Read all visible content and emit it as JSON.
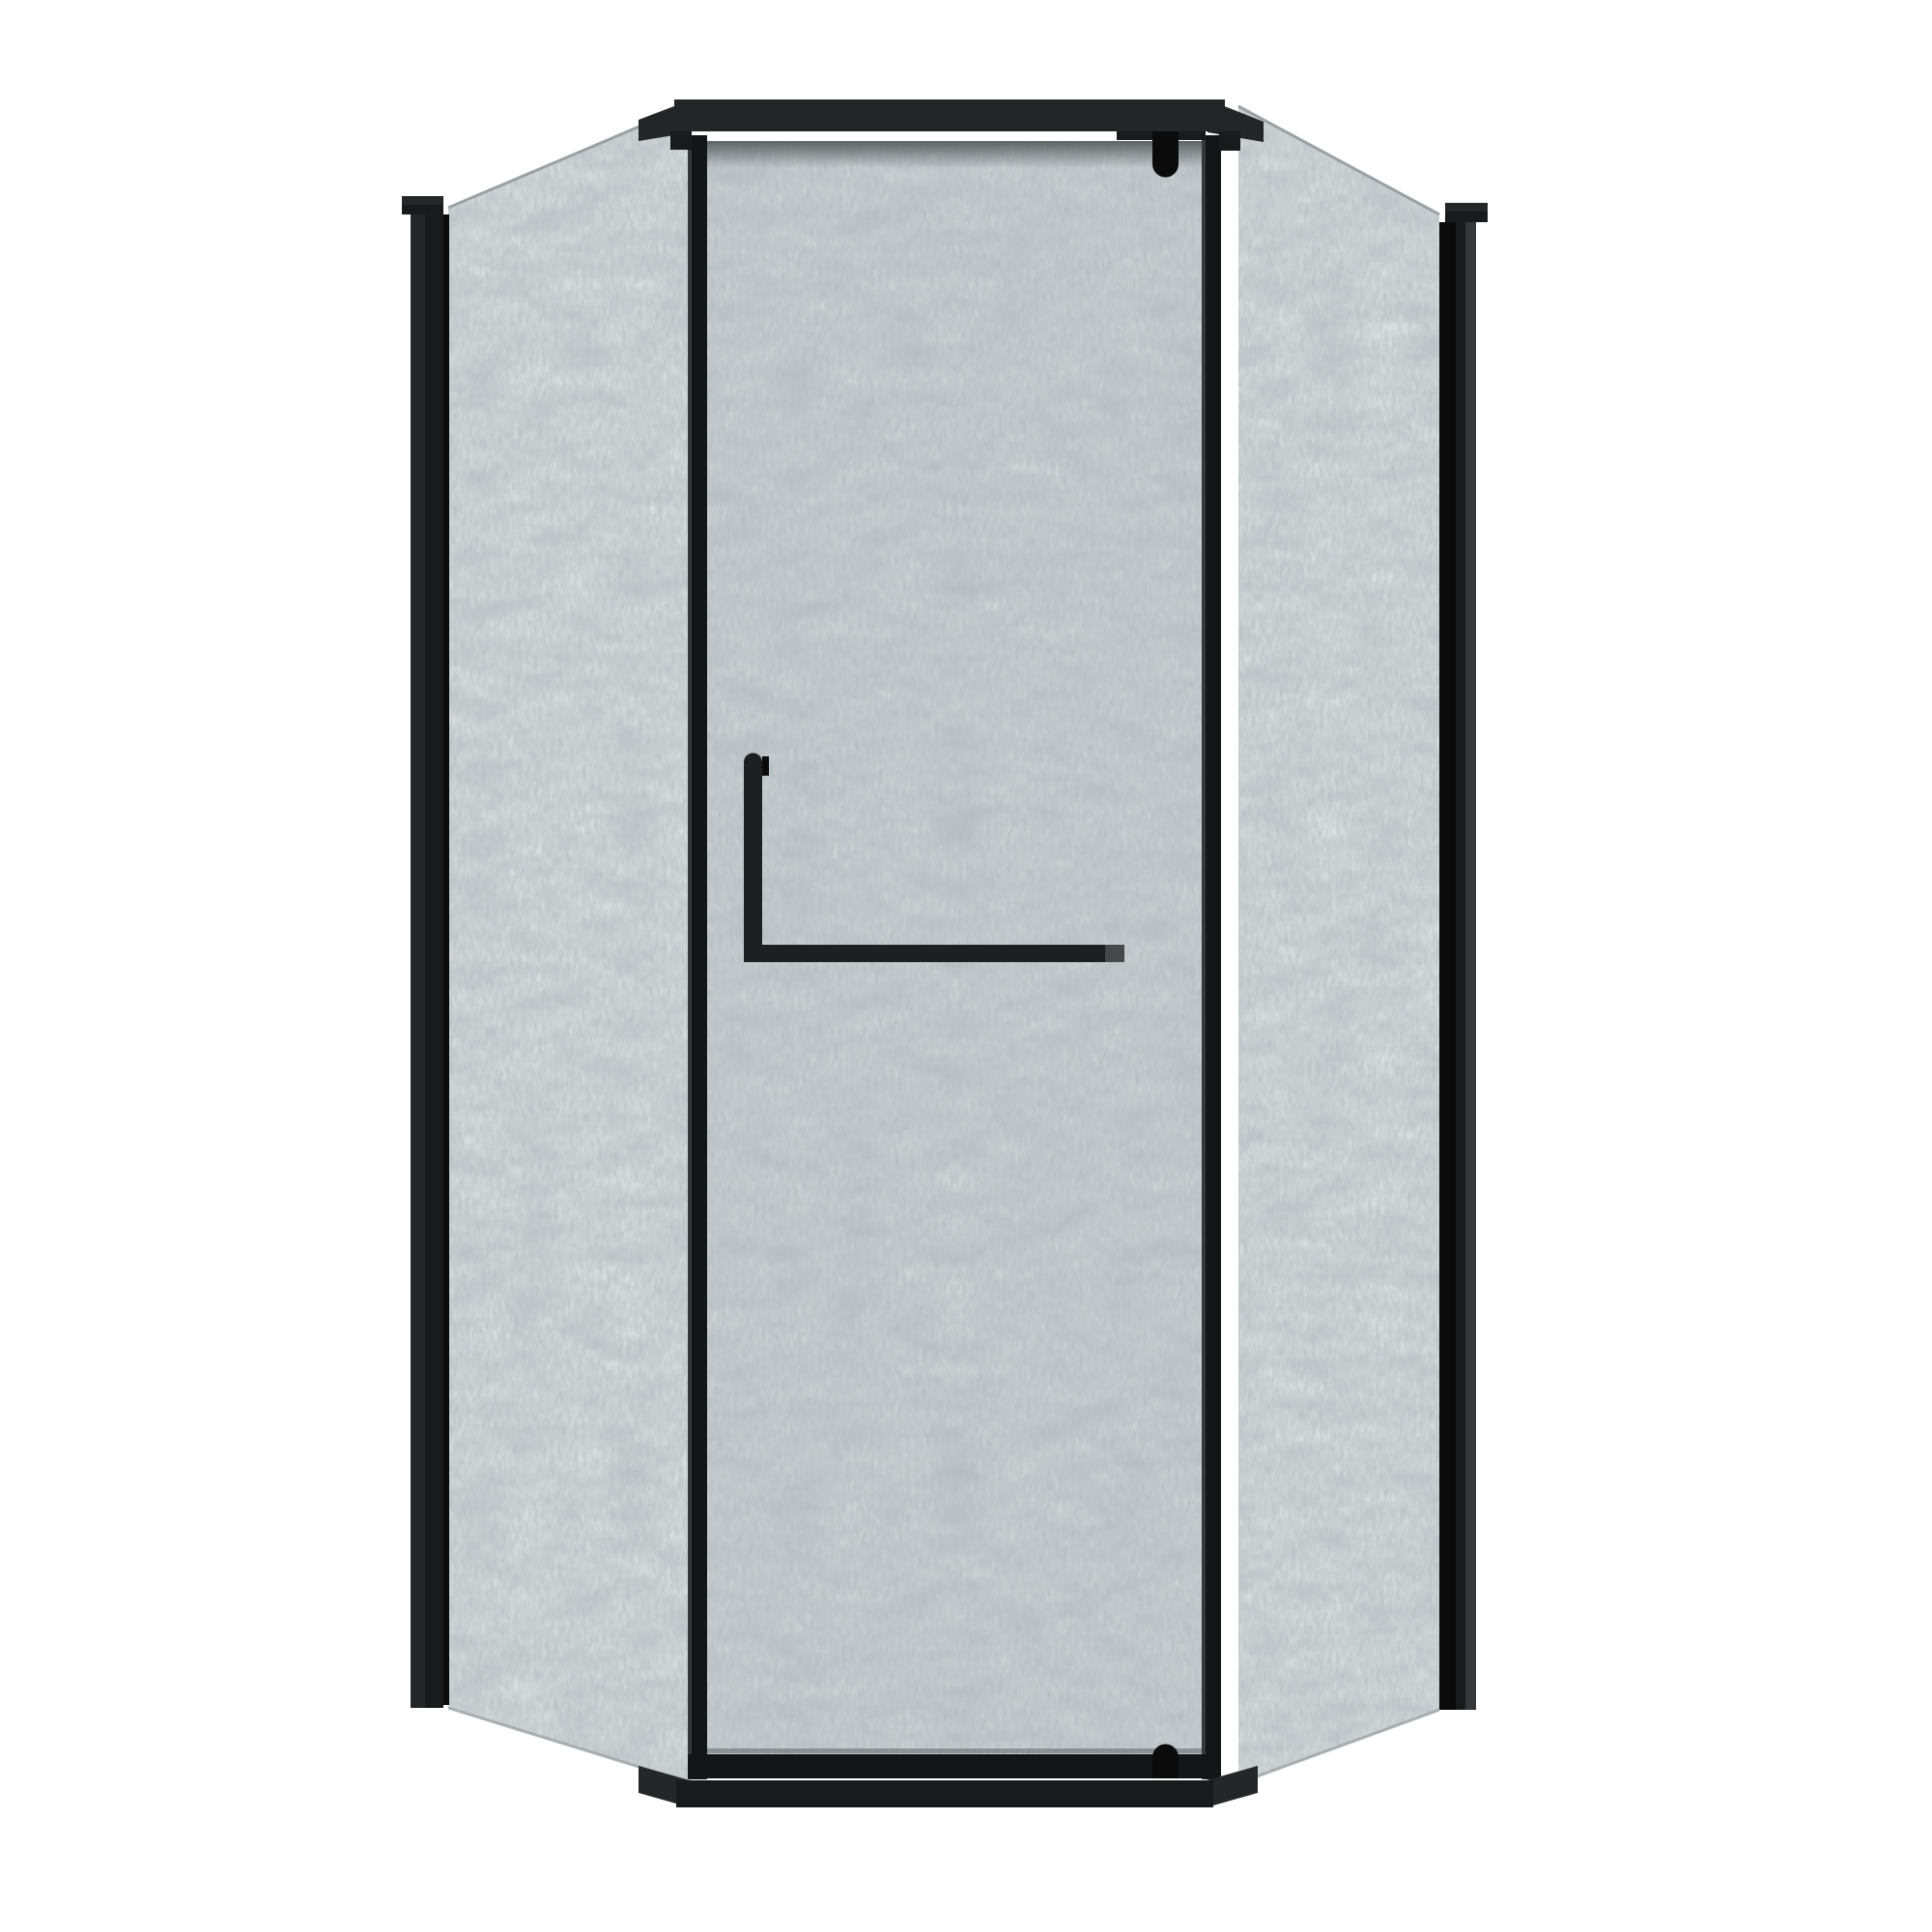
{
  "scene": {
    "type": "3d-product-render",
    "product": "neo-angle corner shower enclosure",
    "frame_finish": "matte black",
    "glass_finish": "frosted privacy glass",
    "background": "plain white, no shadows"
  },
  "components": {
    "left_wall_profile": "black vertical wall mounting profile, left",
    "right_wall_profile": "black vertical wall mounting profile, right",
    "left_glass_panel": "angled frosted side panel, left",
    "right_glass_panel": "angled frosted side panel, right",
    "door_glass": "center pivot door, frosted glass",
    "header_rail": "black top header rail with angled returns",
    "threshold_rail": "black bottom threshold rail with angled returns",
    "top_pivot_hinge": "round-bottom pivot hinge tab at header",
    "bottom_pivot_hinge": "round-top pivot hinge tab at threshold",
    "door_handle": "L-shaped black handle with towel bar and light end cap"
  },
  "palette": {
    "bg": "#ffffff",
    "frame_darkest": "#0b0b0c",
    "frame_dark": "#191a1b",
    "frame_mid": "#242628",
    "frame_light": "#35373a",
    "header": "#232527",
    "post_dark": "#141516",
    "glass_base": "#e9edee",
    "glass_edge": "#9aa1a4",
    "glass_shadow": "#4a5254",
    "handle": "#1d1f20",
    "handle_cap": "#464849"
  }
}
